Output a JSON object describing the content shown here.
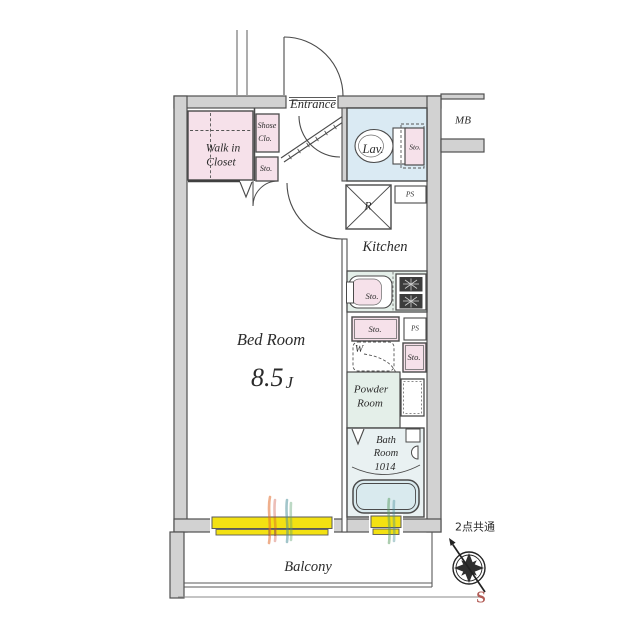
{
  "floorplan": {
    "entrance": "Entrance",
    "mb": "MB",
    "walk_in_closet_1": "Walk in",
    "walk_in_closet_2": "Closet",
    "shoe_closet_1": "Shose",
    "shoe_closet_2": "Clo.",
    "sto_entrance": "Sto.",
    "lav": "Lav.",
    "sto_lav": "Sto.",
    "refrigerator": "R",
    "ps_top": "PS",
    "kitchen": "Kitchen",
    "sto_sink": "Sto.",
    "sto_below_sink": "Sto.",
    "ps_mid": "PS",
    "washer": "W",
    "sto_right": "Sto.",
    "powder_1": "Powder",
    "powder_2": "Room",
    "bedroom_name": "Bed Room",
    "bedroom_size": "8.5",
    "bedroom_size_unit": "J",
    "bath_1": "Bath",
    "bath_2": "Room",
    "bath_3": "1014",
    "balcony": "Balcony",
    "compass_note": "2点共通",
    "compass_south": "S"
  },
  "colors": {
    "wall_fill": "#d2d2d2",
    "wall_stroke": "#4f4f4f",
    "closet_pink": "#f6e1ea",
    "lav_blue": "#daeaf3",
    "wet_green": "#e4efe9",
    "bath_blue": "#e9f1f2",
    "tub_blue": "#d9eaee",
    "window_yellow": "#f3e112",
    "south_red": "#b25b55"
  }
}
